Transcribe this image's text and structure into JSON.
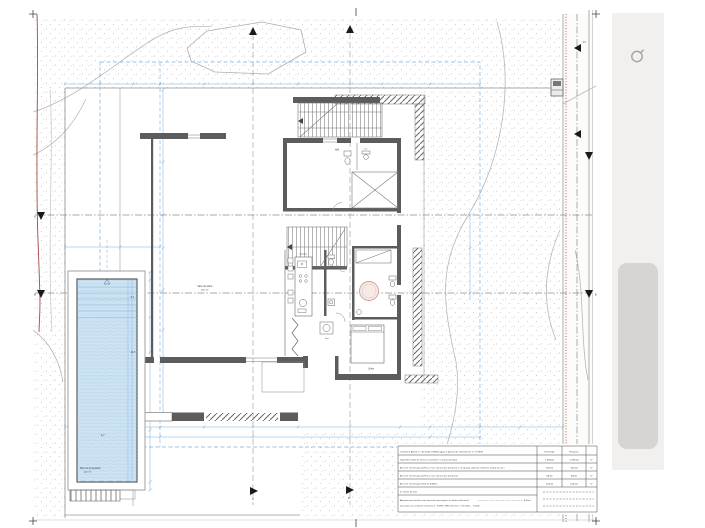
{
  "table": {
    "note": "Conforme Alvará n.º 617/2021 (PDM Lagoa) e Alvará de Loteamento n.º 5/1999",
    "col_permitido": "Permitido",
    "col_proposto": "Proposto",
    "rows": [
      {
        "label": "Superfície Total do Terreno (conforme escritura predial)",
        "permitido": "1.098,00",
        "proposto": "1.098,00",
        "unit": "m²"
      },
      {
        "label": "Área de Construção do Piso 0 (inc. área bruta privativa e circulação coberta conforme alvará de lot.)",
        "permitido": "160,00",
        "proposto": "160,00",
        "unit": "m²"
      },
      {
        "label": "Área de Construção do Piso 1 (inc. área bruta privativa)",
        "permitido": "84,00",
        "proposto": "84,00",
        "unit": "m²"
      },
      {
        "label": "Área de Construção Total do Edifício",
        "permitido": "224,00",
        "proposto": "224,00",
        "unit": "m²"
      }
    ],
    "row_a": "a) Limite do lote",
    "setback_label": "Afastamento frontal (entre área de construção e os limites dos lotes)",
    "setback_value": "4,00m",
    "setback_note": "(de acordo com o alvará de loteamento n.º 5/1999 e PDM cadernetas n.º 617/2021 — 1/1000)"
  },
  "pool": {
    "label": "Piscina (proposta)",
    "area": "40,0 m²",
    "length": "12,5",
    "width": "4,7",
    "lane": "2,7"
  },
  "rooms": {
    "living": "Sala de estar",
    "living_area": "43,5 m²",
    "kitchen": "Cozinha",
    "entry": "Hall",
    "wc": "I.S.",
    "suite": "Suite",
    "laundry": "Lav."
  },
  "markers": {
    "a": "A",
    "b": "B",
    "c": "C",
    "d": "D",
    "road": "12"
  },
  "sidebar": {
    "refresh_icon": "rotate-refresh-icon"
  },
  "colors": {
    "accent_blue": "#7fb0d8",
    "boundary_red": "#9d4f3d",
    "pool_water": "#cde3f3",
    "wall_gray": "#5c5c5c",
    "sidebar_bg": "#f1f0ee",
    "scroll_thumb": "#d6d5d3",
    "stipple_dot": "#bcbcbc"
  }
}
